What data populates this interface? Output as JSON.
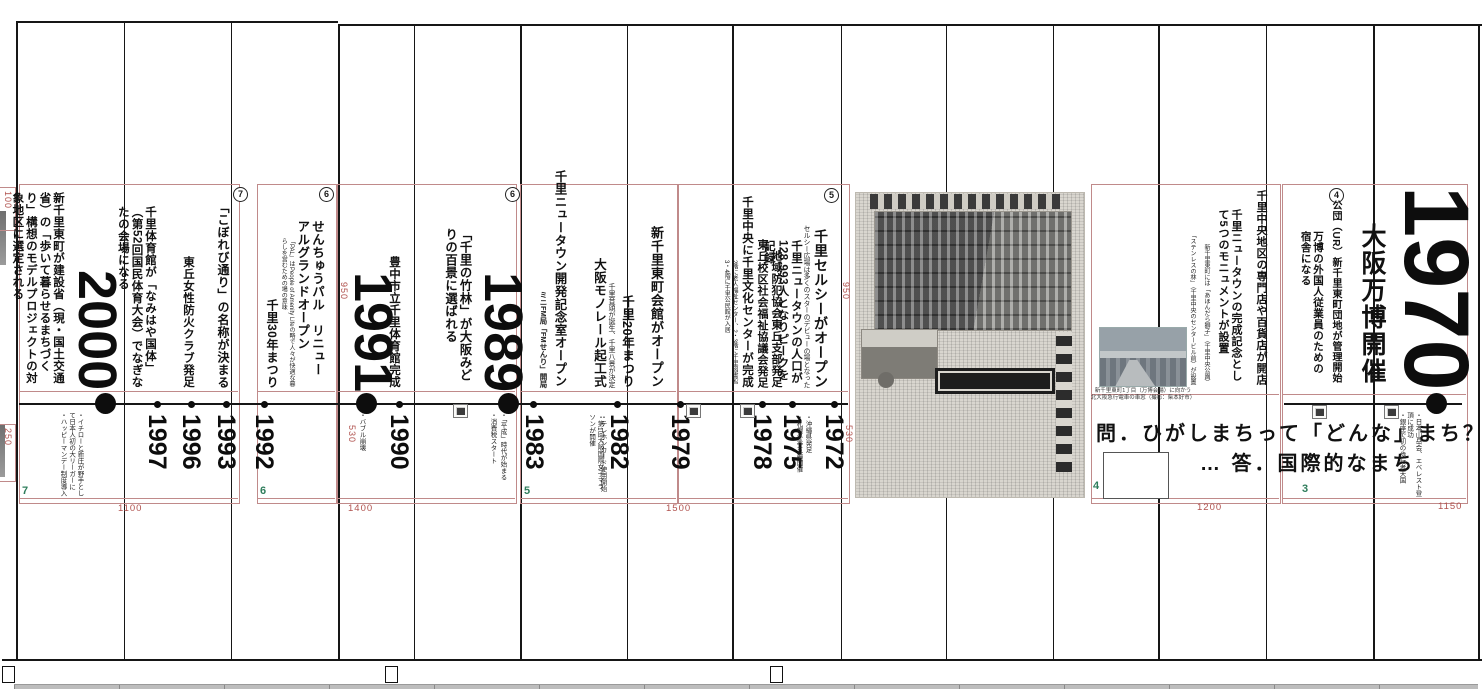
{
  "sections": {
    "s7": {
      "circled": "7",
      "page_no": "7",
      "e2000": {
        "year": "2000",
        "title": "新千里東町が建設省（現・国土交通省）の「歩いて暮らせるまちづくり」構想のモデルプロジェクトの対象地区に選定される",
        "notes": [
          "・イチローと新庄が野手として日本人初の大リーガーに",
          "・ハッピーマンデー制度導入"
        ]
      },
      "e1997": {
        "year": "1997",
        "title": "千里体育館が「なみはや国体」（第52回国民体育大会）でなぎなたの会場になる"
      },
      "e1996": {
        "year": "1996",
        "title": "東丘女性防火クラブ発足"
      },
      "e1993": {
        "year": "1993",
        "title": "「こぼれび通り」の名称が決まる"
      }
    },
    "s6": {
      "circled_a": "6",
      "circled_b": "6",
      "page_no": "6",
      "e1992": {
        "year": "1992",
        "title": "せんちゅうパル　リニューアルグランドオープン",
        "note": "「PAL」はPeople of Amenity Lifeの略で人々が快適な暮らしを営むための場の意味",
        "title2": "千里30年まつり"
      },
      "e1991": {
        "year": "1991",
        "title": "豊中市立千里体育館完成",
        "notes": [
          "・バブル崩壊"
        ]
      },
      "e1990": {
        "year": "1990"
      },
      "e1989": {
        "year": "1989",
        "title": "「千里の竹林」が大阪みどりの百景に選ばれる",
        "notes": [
          "・「平成」時代が始まる",
          "・消費税スタート"
        ]
      }
    },
    "s5": {
      "circled": "5",
      "page_no": "5",
      "e1983": {
        "year": "1983",
        "title": "千里ニュータウン開発記念室オープン",
        "sub": "ミニFM局「FMせんり」開局"
      },
      "e1982": {
        "year": "1982",
        "title": "千里20年まつり",
        "sub": "千里音頭が誕生、千里八景が決定",
        "title2": "大阪モノレール起工式",
        "notes": [
          "・テレホンカード使用開始",
          "・第1回大阪国際女子マラソンが開催"
        ]
      },
      "e1979": {
        "year": "1979",
        "title": "新千里東町会館がオープン"
      },
      "e1978": {
        "year": "1978",
        "title": "千里中央に千里文化センターが完成",
        "floors": "2階に老人福祉センター、2・3階に千里図書館　3・4階に千里公民館が入居",
        "title2": "東丘校区社会福祉協議会発足",
        "title3": "地域防犯協会東丘支部発足"
      },
      "e1975": {
        "year": "1975",
        "title": "千里ニュータウンの人口が128,993人となりピークを記録"
      },
      "e1972": {
        "year": "1972",
        "title": "千里セルシーがオープン",
        "sub": "セルシー広場は多くのスターのデビューの場となった",
        "notes": [
          "・沖縄県発足",
          "・札幌冬季五輪開催"
        ]
      }
    },
    "s4": {
      "page_no": "4",
      "item1": "千里中央地区の専門店や百貨店が開店",
      "item2": "千里ニュータウンの完成記念として5つのモニュメントが設置",
      "note1": "新千里東町には「あほんだら獅子」（千里中央公園）",
      "note2": "「ステンレスの林」（千里中央のセンタービル前）が設置",
      "photo_caption1": "新千里東町1丁目（万博会場）に向かう",
      "photo_caption2": "北大阪急行電車の車窓（撮影：柴本好市）",
      "question": "問．ひがしまちって「どんな」まち？",
      "answer": "… 答．国際的なまち"
    },
    "s3": {
      "circled": "4",
      "page_no": "3",
      "year": "1970",
      "headline": "大阪万博開催",
      "title": "公団（UR）新千里東町団地が管理開始",
      "sub": "万博の外国人従業員のための宿舎になる",
      "notes": [
        "・日本山岳会、エベレスト登頂に成功",
        "・銀座で初の歩行者天国"
      ]
    },
    "dims": {
      "d100": "100",
      "d250": "250",
      "d950a": "950",
      "d530a": "530",
      "d950b": "950",
      "d530b": "530",
      "d1100": "1100",
      "d1400": "1400",
      "d1500": "1500",
      "d1200": "1200",
      "d1150": "1150"
    }
  }
}
